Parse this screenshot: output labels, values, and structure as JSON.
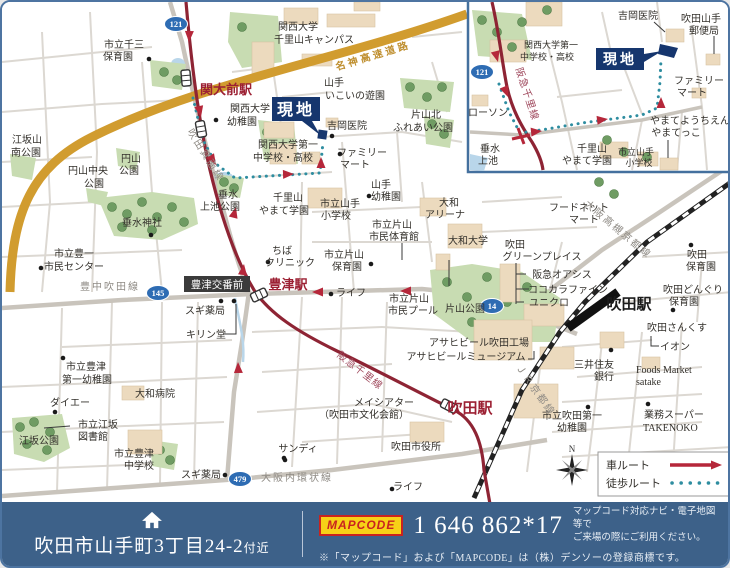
{
  "footer": {
    "address": "吹田市山手町3丁目24-2",
    "address_suffix": "付近",
    "mapcode_logo": "MAPCODE",
    "mapcode_value": "1 646 862*17",
    "mapcode_note_line1": "マップコード対応ナビ・電子地図等で",
    "mapcode_note_line2": "ご来場の際にご利用ください。",
    "trademark_note": "※「マップコード」および「MAPCODE」は（株）デンソーの登録商標です。"
  },
  "legend": {
    "car_route": "車ルート",
    "walk_route": "徒歩ルート",
    "north": "N"
  },
  "colors": {
    "footer_bg": "#3d6189",
    "site_navy": "#16366e",
    "station_red": "#9c2033",
    "railway_maroon": "#8e2434",
    "route_arrow_red": "#b5273a",
    "walk_teal": "#2e8da0",
    "badge_blue": "#2e6cb3",
    "highway_gold": "#d19c2f"
  },
  "map": {
    "site_label": "現地",
    "police_box_label": "豊津交番前",
    "route_badges": [
      {
        "n": "121",
        "x": 174,
        "y": 22
      },
      {
        "n": "145",
        "x": 156,
        "y": 291
      },
      {
        "n": "14",
        "x": 490,
        "y": 304
      },
      {
        "n": "479",
        "x": 238,
        "y": 477
      },
      {
        "n": "121",
        "x": 480,
        "y": 70
      }
    ],
    "stations": [
      {
        "x": 184,
        "y": 76,
        "r": 85
      },
      {
        "x": 199,
        "y": 127,
        "r": 80
      },
      {
        "x": 257,
        "y": 293,
        "r": -25
      },
      {
        "x": 447,
        "y": 404,
        "r": 27
      }
    ],
    "poi_dots": [
      [
        147,
        57
      ],
      [
        330,
        134
      ],
      [
        214,
        118
      ],
      [
        338,
        152
      ],
      [
        367,
        194
      ],
      [
        149,
        233
      ],
      [
        266,
        260
      ],
      [
        369,
        262
      ],
      [
        39,
        266
      ],
      [
        219,
        299
      ],
      [
        232,
        299
      ],
      [
        329,
        292
      ],
      [
        689,
        243
      ],
      [
        671,
        308
      ],
      [
        609,
        348
      ],
      [
        646,
        402
      ],
      [
        586,
        405
      ],
      [
        283,
        458
      ],
      [
        390,
        487
      ],
      [
        61,
        356
      ],
      [
        53,
        410
      ],
      [
        223,
        473
      ],
      [
        282,
        456
      ]
    ],
    "labels": [
      {
        "t": "市立千三",
        "x": 122,
        "y": 46
      },
      {
        "t": "保育園",
        "x": 116,
        "y": 58
      },
      {
        "t": "関大前駅",
        "x": 224,
        "y": 92,
        "s": 13,
        "c": "red"
      },
      {
        "t": "関西大学",
        "x": 296,
        "y": 28
      },
      {
        "t": "千里山キャンパス",
        "x": 312,
        "y": 41
      },
      {
        "t": "名神高速道路",
        "x": 372,
        "y": 57,
        "c": "hwy",
        "r": -17
      },
      {
        "t": "山手",
        "x": 332,
        "y": 84
      },
      {
        "t": "いこいの遊園",
        "x": 353,
        "y": 97
      },
      {
        "t": "片山北",
        "x": 424,
        "y": 116
      },
      {
        "t": "ふれあい公園",
        "x": 421,
        "y": 129
      },
      {
        "t": "吉岡医院",
        "x": 345,
        "y": 127
      },
      {
        "t": "関西大学",
        "x": 248,
        "y": 110
      },
      {
        "t": "幼稚園",
        "x": 240,
        "y": 123
      },
      {
        "t": "関西大学第一",
        "x": 286,
        "y": 146
      },
      {
        "t": "中学校・高校",
        "x": 281,
        "y": 159
      },
      {
        "t": "ファミリー",
        "x": 360,
        "y": 154
      },
      {
        "t": "マート",
        "x": 353,
        "y": 166
      },
      {
        "t": "山手",
        "x": 379,
        "y": 186
      },
      {
        "t": "幼稚園",
        "x": 384,
        "y": 198
      },
      {
        "t": "江坂山",
        "x": 25,
        "y": 141
      },
      {
        "t": "南公園",
        "x": 24,
        "y": 154
      },
      {
        "t": "円山中央",
        "x": 86,
        "y": 172
      },
      {
        "t": "公園",
        "x": 92,
        "y": 185
      },
      {
        "t": "円山",
        "x": 129,
        "y": 160
      },
      {
        "t": "公園",
        "x": 127,
        "y": 172
      },
      {
        "t": "垂水神社",
        "x": 140,
        "y": 224
      },
      {
        "t": "垂水",
        "x": 226,
        "y": 196
      },
      {
        "t": "上池公園",
        "x": 218,
        "y": 208
      },
      {
        "t": "千里山",
        "x": 286,
        "y": 199
      },
      {
        "t": "やまて学園",
        "x": 282,
        "y": 212
      },
      {
        "t": "市立山手",
        "x": 338,
        "y": 205
      },
      {
        "t": "小学校",
        "x": 334,
        "y": 217
      },
      {
        "t": "大和",
        "x": 447,
        "y": 204
      },
      {
        "t": "アリーナ",
        "x": 443,
        "y": 216
      },
      {
        "t": "市立片山",
        "x": 390,
        "y": 226
      },
      {
        "t": "市民体育館",
        "x": 392,
        "y": 238
      },
      {
        "t": "大和大学",
        "x": 466,
        "y": 242
      },
      {
        "t": "ちば",
        "x": 280,
        "y": 252
      },
      {
        "t": "クリニック",
        "x": 288,
        "y": 264
      },
      {
        "t": "市立片山",
        "x": 342,
        "y": 256
      },
      {
        "t": "保育園",
        "x": 345,
        "y": 268
      },
      {
        "t": "市立豊一",
        "x": 72,
        "y": 255
      },
      {
        "t": "市民センター",
        "x": 72,
        "y": 268
      },
      {
        "t": "豊中吹田線",
        "x": 108,
        "y": 288,
        "c": "road"
      },
      {
        "t": "吹田箕面線",
        "x": 201,
        "y": 155,
        "c": "road",
        "r": 58
      },
      {
        "t": "豊津駅",
        "x": 286,
        "y": 287,
        "s": 13,
        "c": "red"
      },
      {
        "t": "スギ薬局",
        "x": 203,
        "y": 312
      },
      {
        "t": "キリン堂",
        "x": 204,
        "y": 336
      },
      {
        "t": "ライフ",
        "x": 349,
        "y": 294
      },
      {
        "t": "市立片山",
        "x": 407,
        "y": 300
      },
      {
        "t": "市民プール",
        "x": 411,
        "y": 312
      },
      {
        "t": "片山公園",
        "x": 463,
        "y": 310
      },
      {
        "t": "吹田",
        "x": 513,
        "y": 246
      },
      {
        "t": "グリーンプレイス",
        "x": 540,
        "y": 258
      },
      {
        "t": "阪急オアシス",
        "x": 560,
        "y": 276
      },
      {
        "t": "ココカラファイン",
        "x": 566,
        "y": 291
      },
      {
        "t": "ユニクロ",
        "x": 547,
        "y": 304
      },
      {
        "t": "フードネット",
        "x": 577,
        "y": 209
      },
      {
        "t": "マート",
        "x": 582,
        "y": 221
      },
      {
        "t": "大阪高槻京都線",
        "x": 614,
        "y": 230,
        "c": "road",
        "r": 40
      },
      {
        "t": "吹田駅",
        "x": 627,
        "y": 307,
        "s": 15,
        "c": "blk"
      },
      {
        "t": "吹田",
        "x": 695,
        "y": 256
      },
      {
        "t": "保育園",
        "x": 699,
        "y": 268
      },
      {
        "t": "吹田どんぐり",
        "x": 691,
        "y": 291
      },
      {
        "t": "保育園",
        "x": 682,
        "y": 303
      },
      {
        "t": "吹田さんくす",
        "x": 675,
        "y": 329
      },
      {
        "t": "イオン",
        "x": 673,
        "y": 348
      },
      {
        "t": "三井住友",
        "x": 592,
        "y": 366
      },
      {
        "t": "銀行",
        "x": 602,
        "y": 378
      },
      {
        "t": "Foods Market",
        "x": 634,
        "y": 371,
        "a": "start"
      },
      {
        "t": "satake",
        "x": 634,
        "y": 383,
        "a": "start"
      },
      {
        "t": "業務スーパー",
        "x": 642,
        "y": 416,
        "a": "start"
      },
      {
        "t": "TAKENOKO",
        "x": 641,
        "y": 429,
        "a": "start"
      },
      {
        "t": "市立吹田第一",
        "x": 570,
        "y": 417
      },
      {
        "t": "幼稚園",
        "x": 570,
        "y": 429
      },
      {
        "t": "アサヒビール吹田工場",
        "x": 477,
        "y": 344
      },
      {
        "t": "アサヒビールミュージアム",
        "x": 464,
        "y": 358
      },
      {
        "t": "メイシアター",
        "x": 382,
        "y": 404
      },
      {
        "t": "（吹田市文化会館）",
        "x": 362,
        "y": 416
      },
      {
        "t": "吹田市役所",
        "x": 414,
        "y": 448
      },
      {
        "t": "吹田駅",
        "x": 468,
        "y": 411,
        "s": 15,
        "c": "red"
      },
      {
        "t": "阪急千里線",
        "x": 356,
        "y": 371,
        "c": "rail",
        "r": 38
      },
      {
        "t": "サンディ",
        "x": 296,
        "y": 450
      },
      {
        "t": "大阪内環状線",
        "x": 295,
        "y": 479,
        "c": "road"
      },
      {
        "t": "ライフ",
        "x": 406,
        "y": 488
      },
      {
        "t": "市立豊津",
        "x": 84,
        "y": 368
      },
      {
        "t": "第一幼稚園",
        "x": 85,
        "y": 381
      },
      {
        "t": "ダイエー",
        "x": 68,
        "y": 404
      },
      {
        "t": "大和病院",
        "x": 153,
        "y": 395
      },
      {
        "t": "市立江坂",
        "x": 96,
        "y": 426
      },
      {
        "t": "図書館",
        "x": 91,
        "y": 438
      },
      {
        "t": "江坂公園",
        "x": 37,
        "y": 442
      },
      {
        "t": "市立豊津",
        "x": 132,
        "y": 455
      },
      {
        "t": "中学校",
        "x": 137,
        "y": 467
      },
      {
        "t": "スギ薬局",
        "x": 199,
        "y": 476
      },
      {
        "t": "ＪＲ京都線",
        "x": 531,
        "y": 390,
        "c": "road",
        "r": 55
      },
      {
        "t": "吉岡医院",
        "x": 636,
        "y": 17
      },
      {
        "t": "吹田山手",
        "x": 699,
        "y": 20
      },
      {
        "t": "郵便局",
        "x": 702,
        "y": 32
      },
      {
        "t": "関西大学第一",
        "x": 549,
        "y": 46,
        "s": 9
      },
      {
        "t": "中学校・高校",
        "x": 545,
        "y": 58,
        "s": 9
      },
      {
        "t": "阪急千里線",
        "x": 522,
        "y": 93,
        "c": "rail",
        "r": 72
      },
      {
        "t": "ローソン",
        "x": 486,
        "y": 114
      },
      {
        "t": "ファミリー",
        "x": 697,
        "y": 82
      },
      {
        "t": "マート",
        "x": 690,
        "y": 94
      },
      {
        "t": "やまてようちえん",
        "x": 688,
        "y": 122
      },
      {
        "t": "やまてっこ",
        "x": 674,
        "y": 134
      },
      {
        "t": "千里山",
        "x": 590,
        "y": 150
      },
      {
        "t": "やまて学園",
        "x": 585,
        "y": 162
      },
      {
        "t": "市立山手",
        "x": 634,
        "y": 153,
        "s": 9
      },
      {
        "t": "小学校",
        "x": 637,
        "y": 164,
        "s": 9
      },
      {
        "t": "垂水",
        "x": 488,
        "y": 150
      },
      {
        "t": "上池",
        "x": 486,
        "y": 162
      }
    ]
  }
}
